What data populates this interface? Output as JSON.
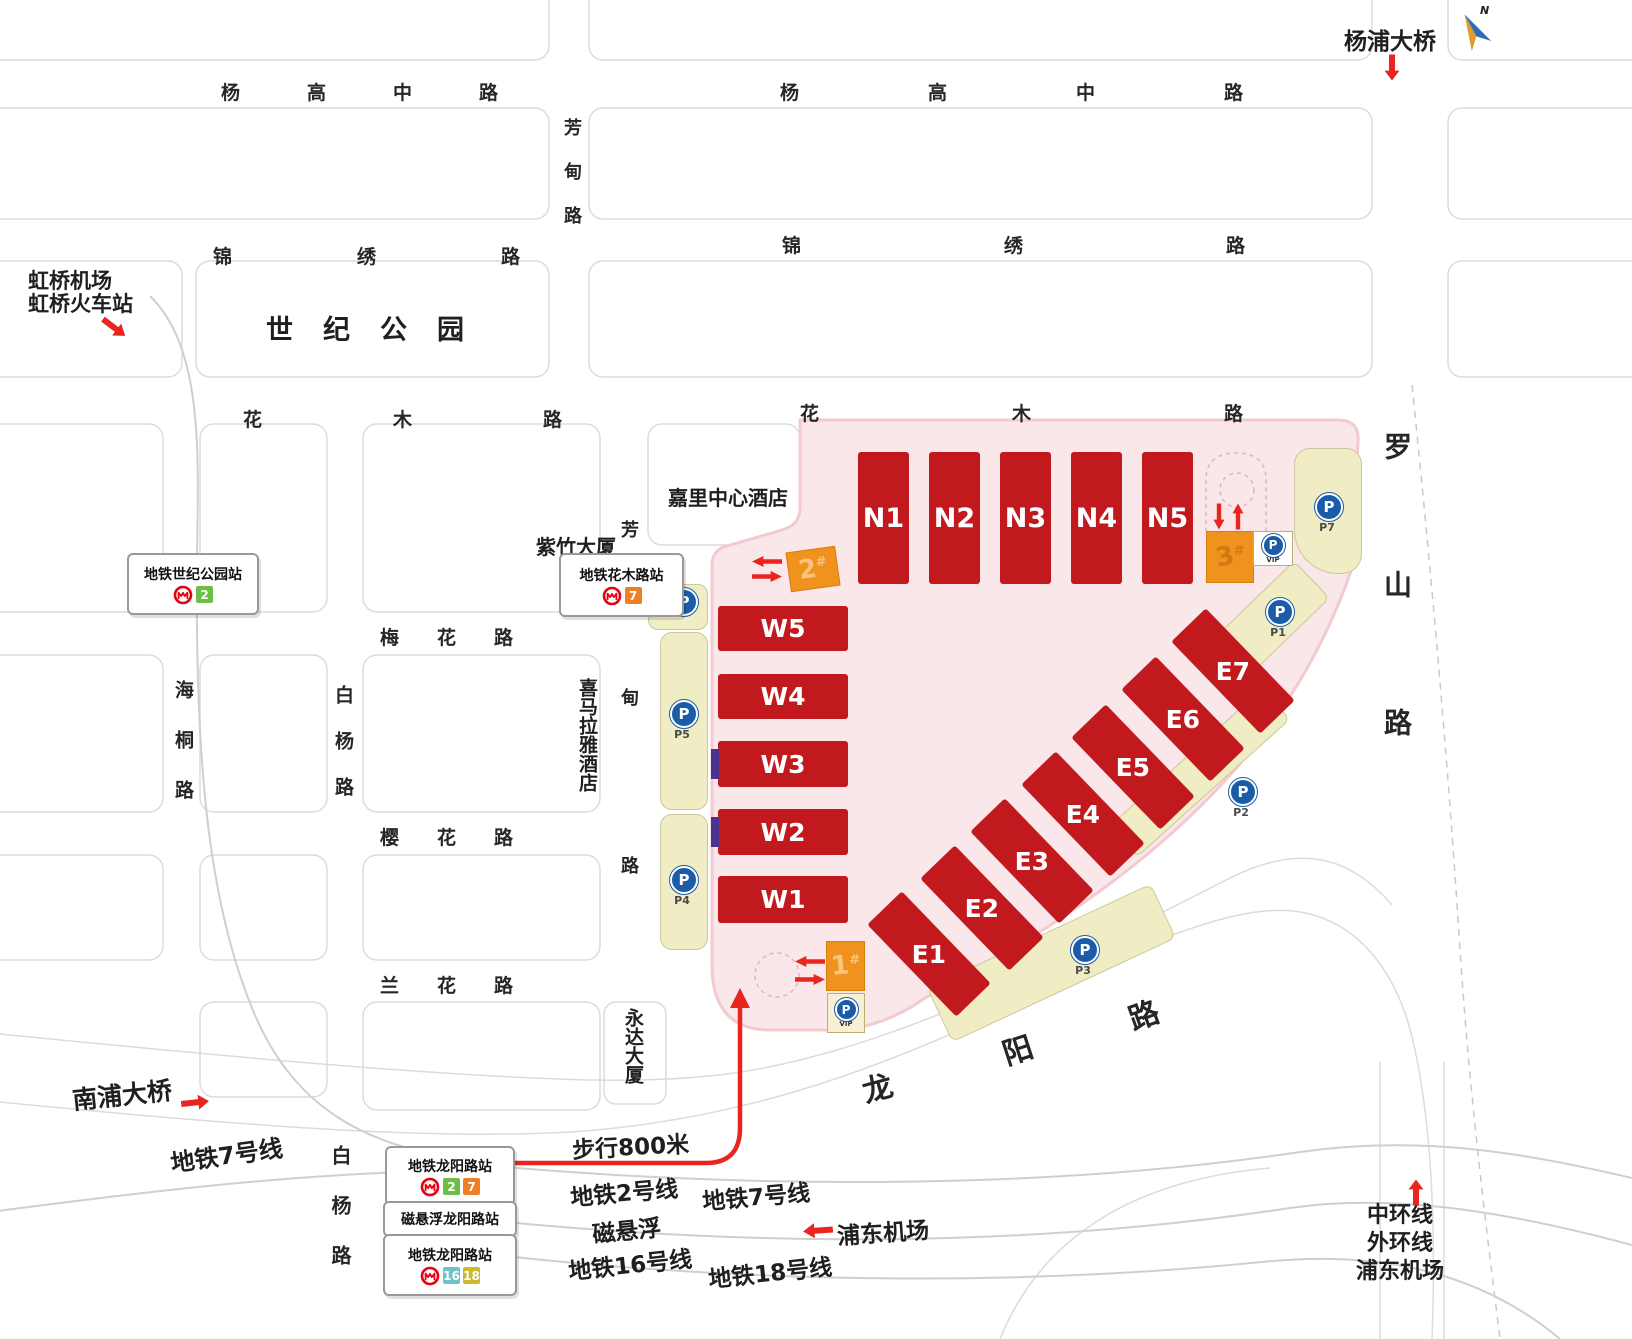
{
  "colors": {
    "hall_red": "#C2191F",
    "venue_pink": "#FAE7EA",
    "venue_border": "#F2CBD0",
    "parking_yellow": "#F0ECC3",
    "gate_orange": "#F0921E",
    "parking_blue": "#1A5CA8",
    "metro_logo_red": "#E60012",
    "line2_green": "#6CBE45",
    "line7_orange": "#EE7F24",
    "line16_teal": "#6EC3C9",
    "line18_yellow": "#CDBA2C",
    "arrow_red": "#E8261F"
  },
  "compass_n": "N",
  "roads": {
    "yanggao_left": "杨高中路",
    "yanggao_right": "杨高中路",
    "jinxiu_left": "锦绣路",
    "jinxiu_right": "锦绣路",
    "fangdian_top": "芳甸路",
    "fangdian_mid": "芳甸路",
    "huamu_left": "花木路",
    "huamu_right": "花木路",
    "meihua": "梅花路",
    "yinghua": "樱花路",
    "lanhua": "兰花路",
    "haitong": "海桐路",
    "baiyang_mid": "白杨路",
    "baiyang_bottom": "白杨路",
    "luoshan": "罗山路",
    "longyang_chars": [
      "龙",
      "阳",
      "路"
    ]
  },
  "landmarks": {
    "yangpu_bridge": "杨浦大桥",
    "hongqiao_line1": "虹桥机场",
    "hongqiao_line2": "虹桥火车站",
    "century_park": "世纪公园",
    "kerry_hotel": "嘉里中心酒店",
    "zizhu_tower": "紫竹大厦",
    "himalaya_hotel": "喜马拉雅酒店",
    "yongda_tower": "永达大厦",
    "nanpu_bridge": "南浦大桥"
  },
  "stations": {
    "century_park": {
      "name": "地铁世纪公园站",
      "lines": [
        "2"
      ]
    },
    "huamu": {
      "name": "地铁花木路站",
      "lines": [
        "7"
      ]
    },
    "longyang_metro27": {
      "name": "地铁龙阳路站",
      "lines": [
        "2",
        "7"
      ]
    },
    "longyang_maglev": {
      "name": "磁悬浮龙阳路站"
    },
    "longyang_metro1618": {
      "name": "地铁龙阳路站",
      "lines": [
        "16",
        "18"
      ]
    }
  },
  "halls": {
    "north": [
      "N1",
      "N2",
      "N3",
      "N4",
      "N5"
    ],
    "west": [
      "W5",
      "W4",
      "W3",
      "W2",
      "W1"
    ],
    "east": [
      "E1",
      "E2",
      "E3",
      "E4",
      "E5",
      "E6",
      "E7"
    ]
  },
  "gates": {
    "hash": "#",
    "g1": "1",
    "g2": "2",
    "g3": "3"
  },
  "parking": {
    "icon_letter": "P",
    "vip": "VIP",
    "p1": "P1",
    "p2": "P2",
    "p3": "P3",
    "p4": "P4",
    "p5": "P5",
    "p7": "P7"
  },
  "transit": {
    "metro_line7_label": "地铁7号线",
    "walk_800": "步行800米",
    "metro_line2": "地铁2号线",
    "metro_line7": "地铁7号线",
    "maglev": "磁悬浮",
    "pudong_airport_west": "浦东机场",
    "metro_line16": "地铁16号线",
    "metro_line18": "地铁18号线",
    "middle_ring": "中环线",
    "outer_ring": "外环线",
    "pudong_airport_south": "浦东机场"
  }
}
